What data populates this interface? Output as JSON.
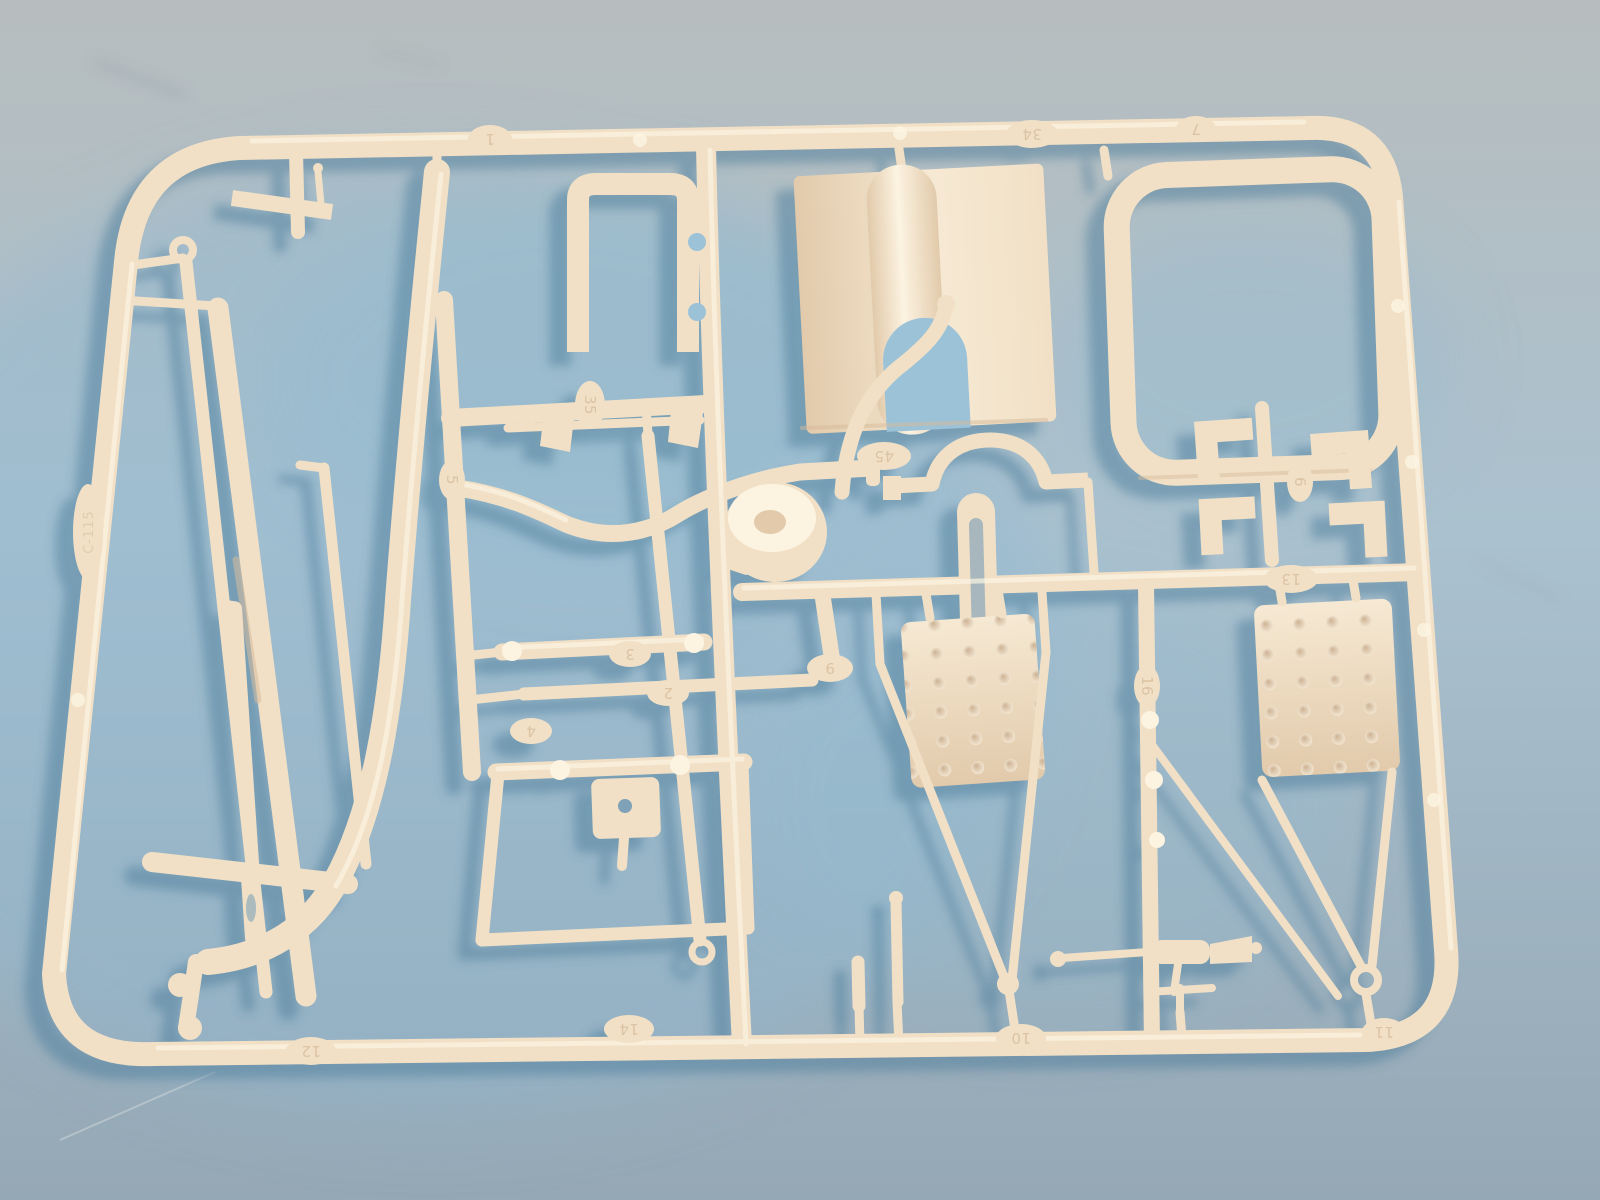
{
  "scene": {
    "type": "photograph",
    "subject": "Plastic model kit sprue (parts tree)",
    "description": "A cream-white injection-molded sprue holding truck model parts, lying on a light blue-gray painted surface. Soft blue shadows fall to the lower left; light comes from the upper right.",
    "plastic_finish": "glossy cream-white polystyrene",
    "background_surface": "light blue tabletop"
  },
  "colors": {
    "bg_top": "#b7bdbe",
    "bg_mid": "#aac1cf",
    "bg_bottom": "#95a8b5",
    "pool_blue": "#8fb9d2",
    "bg_smudge": "#8e9aa0",
    "bg_scratch": "#c9d2d6",
    "plastic_base": "#f1e0c6",
    "plastic_light": "#fcf3e1",
    "plastic_dark": "#d6ba9a",
    "plate_light": "#f6e9d3",
    "plate_dark": "#e2caab",
    "dent_dark": "#cdb294",
    "dent_light": "#f8edda",
    "slot_shadow": "#7fa2b8",
    "notch_bg": "#9cc2d8",
    "shadow": "#4e7e9b",
    "emboss": "#d8bc9c"
  },
  "sprue": {
    "frame": {
      "shape": "rounded rectangle",
      "style": "round runner bars"
    },
    "embossed_numbers": [
      {
        "value": "1",
        "location": "top runner, left"
      },
      {
        "value": "34",
        "location": "top runner, right of roof panel"
      },
      {
        "value": "7",
        "location": "top runner, right"
      },
      {
        "value": "35",
        "location": "mid-left junction tab"
      },
      {
        "value": "5",
        "location": "left vertical runner"
      },
      {
        "value": "45",
        "location": "center runner above fender"
      },
      {
        "value": "6",
        "location": "bracket-cluster runner, right"
      },
      {
        "value": "13",
        "location": "right horizontal runner"
      },
      {
        "value": "9",
        "location": "center vertical runner branch"
      },
      {
        "value": "16",
        "location": "right vertical runner"
      },
      {
        "value": "3",
        "location": "first axle, center-left"
      },
      {
        "value": "2",
        "location": "second axle, center-left"
      },
      {
        "value": "4",
        "location": "beside axle group"
      },
      {
        "value": "12",
        "location": "bottom runner, left"
      },
      {
        "value": "14",
        "location": "bottom runner, center"
      },
      {
        "value": "10",
        "location": "bottom runner, right of center"
      },
      {
        "value": "11",
        "location": "bottom runner, far right"
      }
    ],
    "edge_marking": {
      "value": "C-115",
      "location": "left frame bar, vertical"
    },
    "parts": [
      {
        "name": "outer-frame",
        "desc": "rounded rectangular runner frame"
      },
      {
        "name": "side-rail-curved",
        "desc": "long flat rail curving to a foot at lower left"
      },
      {
        "name": "towbar-eyelet-rod",
        "desc": "long rod with eyelet at upper end"
      },
      {
        "name": "chassis-flat-rail",
        "desc": "long flat chassis rail with slot"
      },
      {
        "name": "thin-rod",
        "desc": "thin straight rod"
      },
      {
        "name": "drag-link-rod",
        "desc": "rod with clevis end"
      },
      {
        "name": "link-rod",
        "desc": "vertical link bar with clevis ring"
      },
      {
        "name": "cab-window-frame",
        "desc": "squared C-shaped frame with two notches"
      },
      {
        "name": "roof-panel",
        "desc": "large panel with rounded hump and U-notch"
      },
      {
        "name": "windshield-frame-ring",
        "desc": "large rounded-rectangle frame ring"
      },
      {
        "name": "slotted-link",
        "desc": "oblong bar with long slot"
      },
      {
        "name": "horn-funnel-axle",
        "desc": "thin axle carrying two funnel shapes"
      },
      {
        "name": "front-axle-bar",
        "desc": "handlebar-shaped dropped axle"
      },
      {
        "name": "air-cleaner-drum",
        "desc": "round drum with spout"
      },
      {
        "name": "exhaust-pipe",
        "desc": "S-curved pipe"
      },
      {
        "name": "rear-fender",
        "desc": "flat bar with wheel-arch hump"
      },
      {
        "name": "l-bracket-cluster",
        "desc": "four small L-shaped brackets"
      },
      {
        "name": "axle-with-collars",
        "desc": "cylinder with end collars"
      },
      {
        "name": "long-axle",
        "desc": "long cylinder with end knobs"
      },
      {
        "name": "mount-bracket",
        "desc": "plate bracket with center hole"
      },
      {
        "name": "ladder-subframe",
        "desc": "rectangular sub-frame"
      },
      {
        "name": "tread-plate-left",
        "desc": "dimpled rectangular plate with hooks"
      },
      {
        "name": "tread-plate-right",
        "desc": "dimpled rectangular plate with hooks"
      },
      {
        "name": "mirror-arm-left",
        "desc": "V-shaped support arms"
      },
      {
        "name": "mirror-arm-right",
        "desc": "V-shaped support arms with eyelet"
      },
      {
        "name": "knuckle-rod",
        "desc": "runner with ball knuckles"
      },
      {
        "name": "mounting-pegs",
        "desc": "two short cylindrical pegs"
      },
      {
        "name": "grease-gun",
        "desc": "small nozzle tool assembly"
      },
      {
        "name": "cross-bar",
        "desc": "thick capsule cross bar"
      },
      {
        "name": "top-flat-bar",
        "desc": "short flat bar with pin"
      }
    ]
  }
}
